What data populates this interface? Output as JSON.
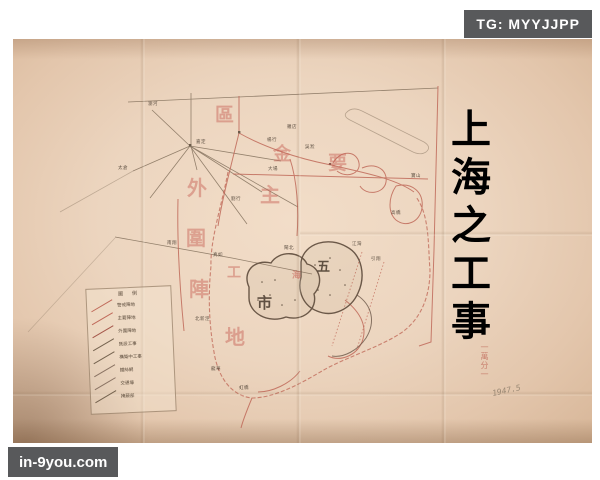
{
  "overlay": {
    "tg_badge": "TG: MYYJJPP",
    "site_watermark": "in-9you.com"
  },
  "colors": {
    "badge_bg": "#58595b",
    "badge_text": "#ffffff",
    "paper": "#ecd5bf",
    "map_red": "#c06a5a",
    "pencil": "#75634f",
    "wm": "rgba(198,92,80,0.45)",
    "wm_strong": "rgba(198,92,80,0.55)",
    "ink": "rgba(70,56,44,0.85)"
  },
  "map": {
    "side_title": "上海之工事",
    "scale_note": "一萬分一",
    "pencil_note": "1947.5",
    "big_chars": [
      {
        "t": "區",
        "x": 215,
        "y": 106,
        "s": 19,
        "c": "wm"
      },
      {
        "t": "金",
        "x": 273,
        "y": 146,
        "s": 18,
        "c": "wm"
      },
      {
        "t": "要",
        "x": 328,
        "y": 154,
        "s": 19,
        "c": "wm"
      },
      {
        "t": "外",
        "x": 187,
        "y": 178,
        "s": 20,
        "c": "wm"
      },
      {
        "t": "主",
        "x": 260,
        "y": 185,
        "s": 20,
        "c": "wm"
      },
      {
        "t": "圍",
        "x": 186,
        "y": 228,
        "s": 20,
        "c": "wm"
      },
      {
        "t": "工",
        "x": 227,
        "y": 266,
        "s": 14,
        "c": "wm"
      },
      {
        "t": "陣",
        "x": 189,
        "y": 279,
        "s": 20,
        "c": "wm"
      },
      {
        "t": "地",
        "x": 225,
        "y": 327,
        "s": 20,
        "c": "wm"
      },
      {
        "t": "五",
        "x": 317,
        "y": 261,
        "s": 13,
        "c": "ink"
      },
      {
        "t": "市",
        "x": 257,
        "y": 296,
        "s": 15,
        "c": "ink"
      },
      {
        "t": "海",
        "x": 292,
        "y": 272,
        "s": 9,
        "c": "wm_strong"
      }
    ],
    "town_labels": [
      {
        "t": "瀏河",
        "x": 148,
        "y": 103
      },
      {
        "t": "嘉定",
        "x": 196,
        "y": 141
      },
      {
        "t": "太倉",
        "x": 118,
        "y": 167
      },
      {
        "t": "羅店",
        "x": 287,
        "y": 126
      },
      {
        "t": "楊行",
        "x": 267,
        "y": 139
      },
      {
        "t": "吳淞",
        "x": 305,
        "y": 146
      },
      {
        "t": "寶山",
        "x": 411,
        "y": 175
      },
      {
        "t": "大場",
        "x": 268,
        "y": 168
      },
      {
        "t": "劉行",
        "x": 231,
        "y": 198
      },
      {
        "t": "南翔",
        "x": 167,
        "y": 242
      },
      {
        "t": "真如",
        "x": 213,
        "y": 254
      },
      {
        "t": "江灣",
        "x": 352,
        "y": 243
      },
      {
        "t": "閘北",
        "x": 284,
        "y": 247
      },
      {
        "t": "引翔",
        "x": 371,
        "y": 258
      },
      {
        "t": "高橋",
        "x": 391,
        "y": 212
      },
      {
        "t": "北新涇",
        "x": 195,
        "y": 318
      },
      {
        "t": "龍華",
        "x": 211,
        "y": 368
      },
      {
        "t": "虹橋",
        "x": 239,
        "y": 387
      }
    ],
    "legend": {
      "header": "圖　例",
      "rows": [
        {
          "label": "警戒陣地",
          "sym_color": "#c06a5a"
        },
        {
          "label": "主要陣地",
          "sym_color": "#c06a5a"
        },
        {
          "label": "外圍陣地",
          "sym_color": "#a5574a"
        },
        {
          "label": "既設工事",
          "sym_color": "#75634f"
        },
        {
          "label": "構築中工事",
          "sym_color": "#75634f"
        },
        {
          "label": "鐵絲網",
          "sym_color": "#8a7363"
        },
        {
          "label": "交通壕",
          "sym_color": "#8a7363"
        },
        {
          "label": "掩蔽部",
          "sym_color": "#75634f"
        }
      ]
    }
  }
}
